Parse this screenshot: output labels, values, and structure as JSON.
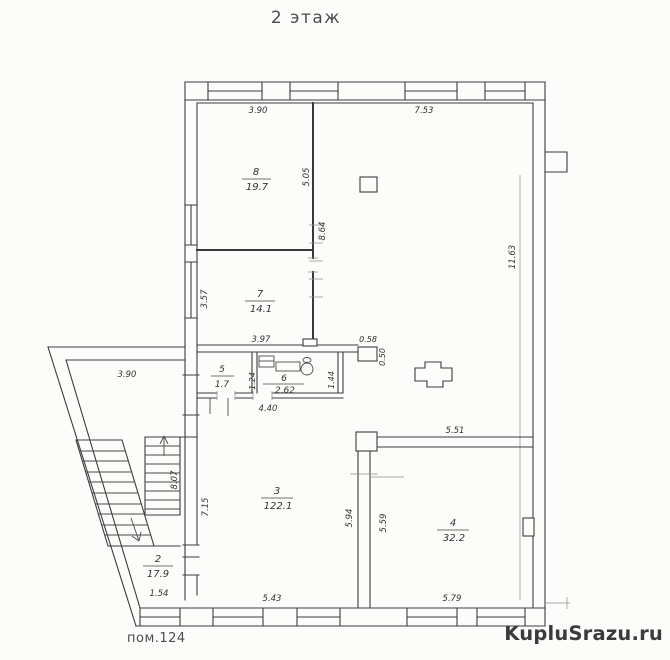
{
  "page": {
    "title": "2 этаж",
    "footer_label": "пом.124",
    "watermark": "KupluSrazu.ru",
    "watermark_color": "#ee3f4b"
  },
  "rooms": {
    "r8": {
      "num": "8",
      "area": "19.7"
    },
    "r7": {
      "num": "7",
      "area": "14.1"
    },
    "r5": {
      "num": "5",
      "area": "1.7"
    },
    "r6": {
      "num": "6",
      "area": "2.62"
    },
    "r3": {
      "num": "3",
      "area": "122.1"
    },
    "r4": {
      "num": "4",
      "area": "32.2"
    },
    "r2": {
      "num": "2",
      "area": "17.9"
    }
  },
  "dims": {
    "top_w1": "3.90",
    "top_w2": "7.53",
    "r8_h": "5.05",
    "wall_87": "8.64",
    "right_h": "11.63",
    "r7_h": "3.57",
    "r7_w": "3.97",
    "col_w": "0.58",
    "col_d": "0.50",
    "wc_l": "1.24",
    "wc_r": "1.44",
    "wc_w": "4.40",
    "annex_top": "3.90",
    "r4_top": "5.51",
    "stair_h": "8.07",
    "r3_l": "7.15",
    "r3_r": "5.94",
    "r4_l": "5.59",
    "r2_b": "1.54",
    "bot_w1": "5.43",
    "bot_w2": "5.79"
  }
}
